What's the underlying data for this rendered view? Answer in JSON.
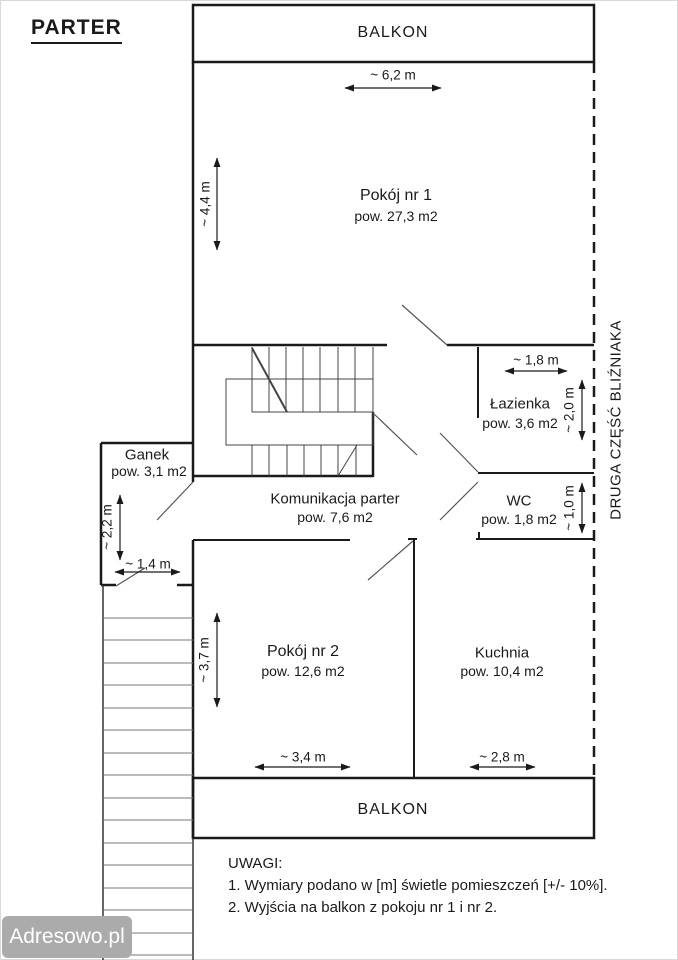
{
  "page": {
    "title": "PARTER"
  },
  "plan": {
    "balcony_top": "BALKON",
    "balcony_bottom": "BALKON",
    "boundary_label": "DRUGA CZĘŚĆ BLIŹNIAKA",
    "rooms": [
      {
        "name": "Pokój nr 1",
        "area": "pow. 27,3 m2"
      },
      {
        "name": "Łazienka",
        "area": "pow. 3,6 m2"
      },
      {
        "name": "WC",
        "area": "pow. 1,8 m2"
      },
      {
        "name": "Komunikacja parter",
        "area": "pow. 7,6 m2"
      },
      {
        "name": "Ganek",
        "area": "pow. 3,1 m2"
      },
      {
        "name": "Pokój nr 2",
        "area": "pow. 12,6 m2"
      },
      {
        "name": "Kuchnia",
        "area": "pow. 10,4 m2"
      }
    ],
    "dimensions": {
      "room1_width": "~ 6,2 m",
      "room1_height": "~ 4,4 m",
      "bathroom_width": "~ 1,8 m",
      "bathroom_height": "~ 2,0 m",
      "wc_height": "~ 1,0 m",
      "porch_height": "~ 2,2 m",
      "porch_width": "~ 1,4 m",
      "room2_height": "~ 3,7 m",
      "room2_width": "~ 3,4 m",
      "kitchen_width": "~ 2,8 m"
    }
  },
  "notes": {
    "heading": "UWAGI:",
    "items": [
      "1. Wymiary podano w [m] świetle pomieszczeń [+/- 10%].",
      "2. Wyjścia na balkon z pokoju nr 1 i nr 2."
    ]
  },
  "watermark": {
    "label": "Adresowo.pl",
    "background": "#ababab",
    "text_color": "#ffffff"
  },
  "colors": {
    "wall": "#1a1a1a",
    "stair_line": "#444444",
    "door_line": "#555555",
    "tread_line": "#777777"
  }
}
